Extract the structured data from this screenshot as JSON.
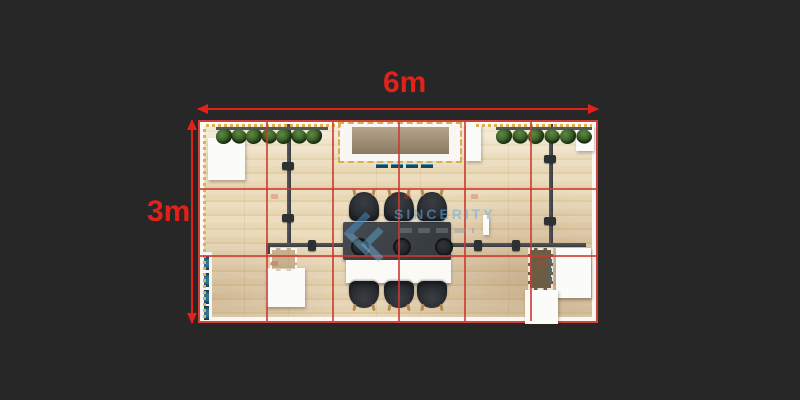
{
  "annotations": {
    "width_label": "6m",
    "height_label": "3m"
  },
  "watermark": {
    "brand_text": "SINCERITY"
  },
  "grid": {
    "columns": 6,
    "rows": 3,
    "cell_size_m": 1
  },
  "colors": {
    "background": "#272727",
    "dimension_red": "#e32119",
    "grid_red": "#cc3a31",
    "floor_wood": "#e9d8b6",
    "wall_white": "#f8f7f4",
    "structure_gray": "#44484d",
    "plant_green": "#39571f",
    "accent_teal": "#2e7396",
    "string_light_gold": "#dcb258",
    "table_dark": "#3a3e44",
    "desk_brown": "#6b5c43"
  },
  "furniture_counts": {
    "chairs_top": 3,
    "chairs_bottom": 3,
    "stools": 3,
    "plant_clusters_left": 7,
    "plant_clusters_right": 6
  }
}
